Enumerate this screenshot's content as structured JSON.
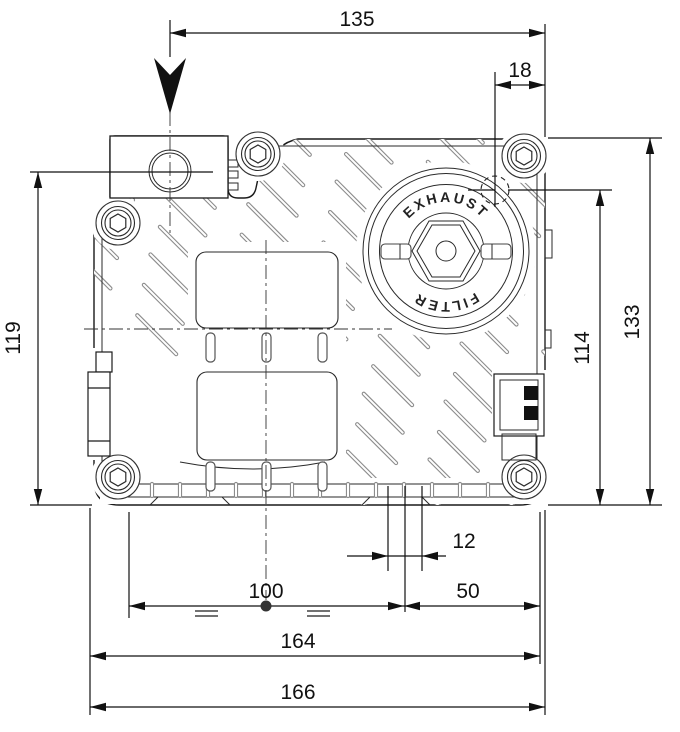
{
  "drawing": {
    "title_hint": "vacuum pump outline dimension drawing",
    "dimensions": {
      "top_width": "135",
      "exhaust_offset": "18",
      "left_height": "119",
      "right_inner_height": "114",
      "right_height": "133",
      "foot_slot_width": "12",
      "mount_spacing": "100",
      "right_mount_offset": "50",
      "mount_width": "164",
      "overall_width": "166"
    },
    "filter_cap": {
      "top_label": "EXHAUST",
      "bottom_label": "FILTER"
    },
    "colors": {
      "line": "#1a1a1a",
      "dimension": "#111111",
      "rib": "#8c8c8c",
      "background": "#ffffff"
    }
  }
}
